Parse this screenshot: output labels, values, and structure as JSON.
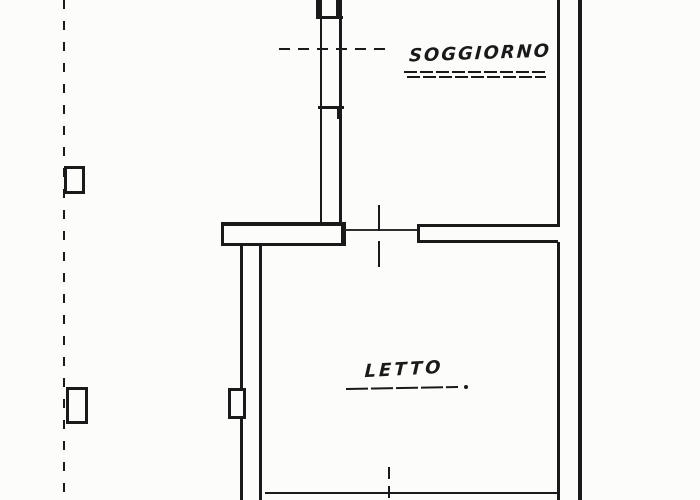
{
  "plan": {
    "rooms": [
      {
        "id": "soggiorno",
        "label": "SOGGIORNO"
      },
      {
        "id": "letto",
        "label": "LETTO"
      }
    ]
  },
  "colors": {
    "ink": "#1a1a1a",
    "ink-soft": "#2e2e2e",
    "paper": "#fcfcfb"
  }
}
